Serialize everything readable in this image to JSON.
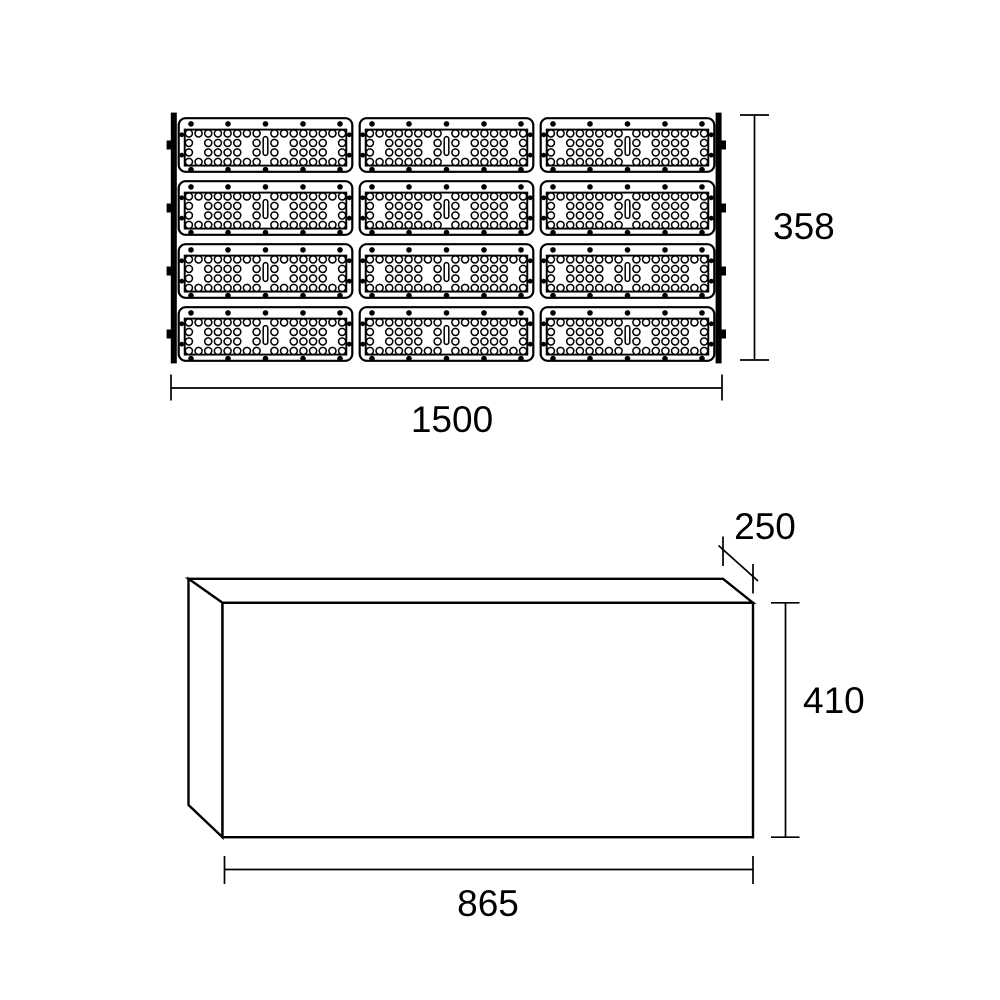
{
  "page": {
    "background_color": "#ffffff",
    "ink_color": "#000000"
  },
  "front_view": {
    "width_dimension": "1500",
    "height_dimension": "358",
    "module_rows": 4,
    "module_columns": 3
  },
  "side_view": {
    "width_dimension": "865",
    "height_dimension": "410",
    "depth_dimension": "250"
  }
}
